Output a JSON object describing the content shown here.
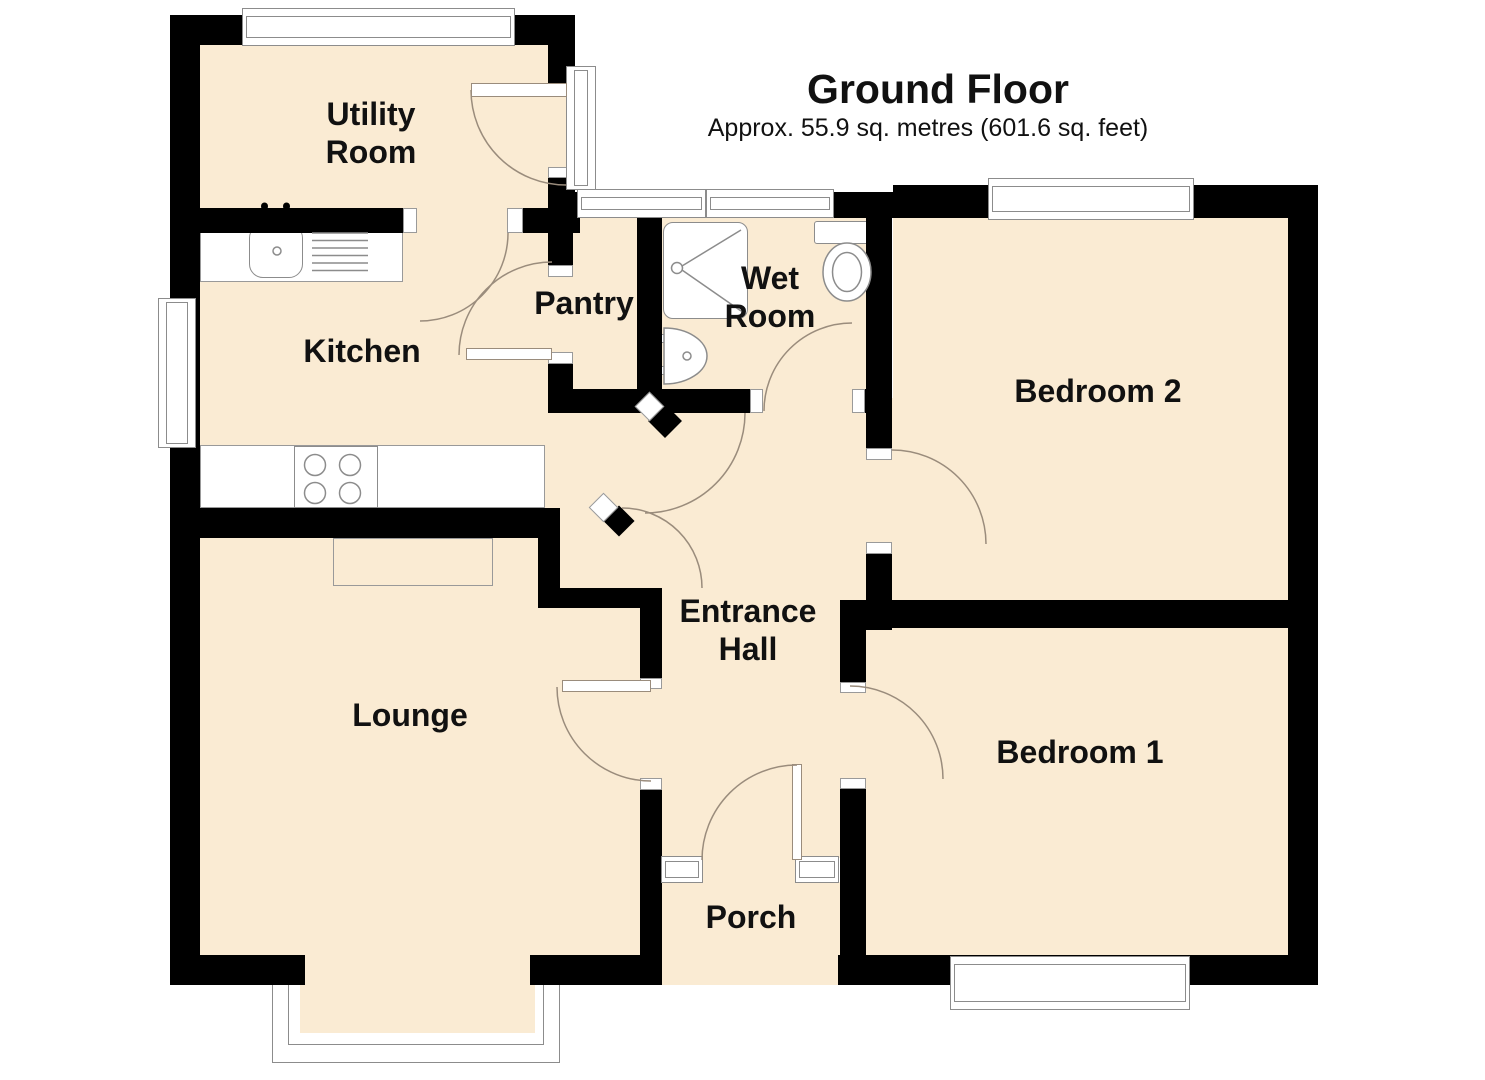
{
  "header": {
    "title": "Ground Floor",
    "subtitle": "Approx. 55.9 sq. metres (601.6 sq. feet)"
  },
  "rooms": [
    {
      "id": "utility-room",
      "lines": [
        "Utility",
        "Room"
      ]
    },
    {
      "id": "kitchen",
      "lines": [
        "Kitchen"
      ]
    },
    {
      "id": "pantry",
      "lines": [
        "Pantry"
      ]
    },
    {
      "id": "wet-room",
      "lines": [
        "Wet",
        "Room"
      ]
    },
    {
      "id": "bedroom-2",
      "lines": [
        "Bedroom 2"
      ]
    },
    {
      "id": "entrance-hall",
      "lines": [
        "Entrance",
        "Hall"
      ]
    },
    {
      "id": "lounge",
      "lines": [
        "Lounge"
      ]
    },
    {
      "id": "bedroom-1",
      "lines": [
        "Bedroom 1"
      ]
    },
    {
      "id": "porch",
      "lines": [
        "Porch"
      ]
    }
  ],
  "fixtures": [
    "kitchen-sink",
    "drainer",
    "taps",
    "hob",
    "worktop",
    "counter",
    "hearth",
    "shower-tray",
    "toilet",
    "wash-basin",
    "bay-window",
    "windows",
    "door-arcs"
  ],
  "colors": {
    "floor": "#FAEBD3",
    "wall": "#000000",
    "fixture_line": "#8C8C8C",
    "door_arc": "#9A8C7C",
    "text": "#111111",
    "background": "#FFFFFF"
  }
}
